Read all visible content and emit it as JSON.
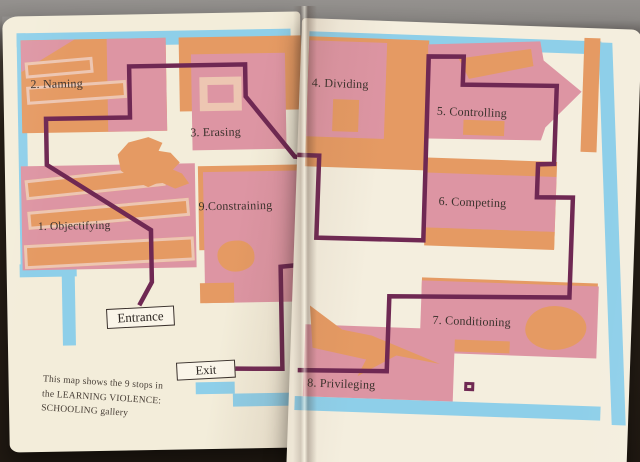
{
  "map": {
    "entrance_label": "Entrance",
    "exit_label": "Exit",
    "caption_lines": [
      "This map shows the 9 stops in",
      "the LEARNING VIOLENCE:",
      "SCHOOLING gallery"
    ]
  },
  "stops": [
    {
      "label": "1. Objectifying"
    },
    {
      "label": "2. Naming"
    },
    {
      "label": "3. Erasing"
    },
    {
      "label": "4. Dividing"
    },
    {
      "label": "5. Controlling"
    },
    {
      "label": "6. Competing"
    },
    {
      "label": "7. Conditioning"
    },
    {
      "label": "8. Privileging"
    },
    {
      "label": "9.Constraining"
    }
  ],
  "colors": {
    "page_cream": "#f3edda",
    "border_blue": "#8ecfe9",
    "room_orange": "#e59a63",
    "room_pink": "#dd95a3",
    "room_outline_light": "#edc6b2",
    "route_purple": "#6f2853",
    "text_dark": "#3a312c"
  }
}
